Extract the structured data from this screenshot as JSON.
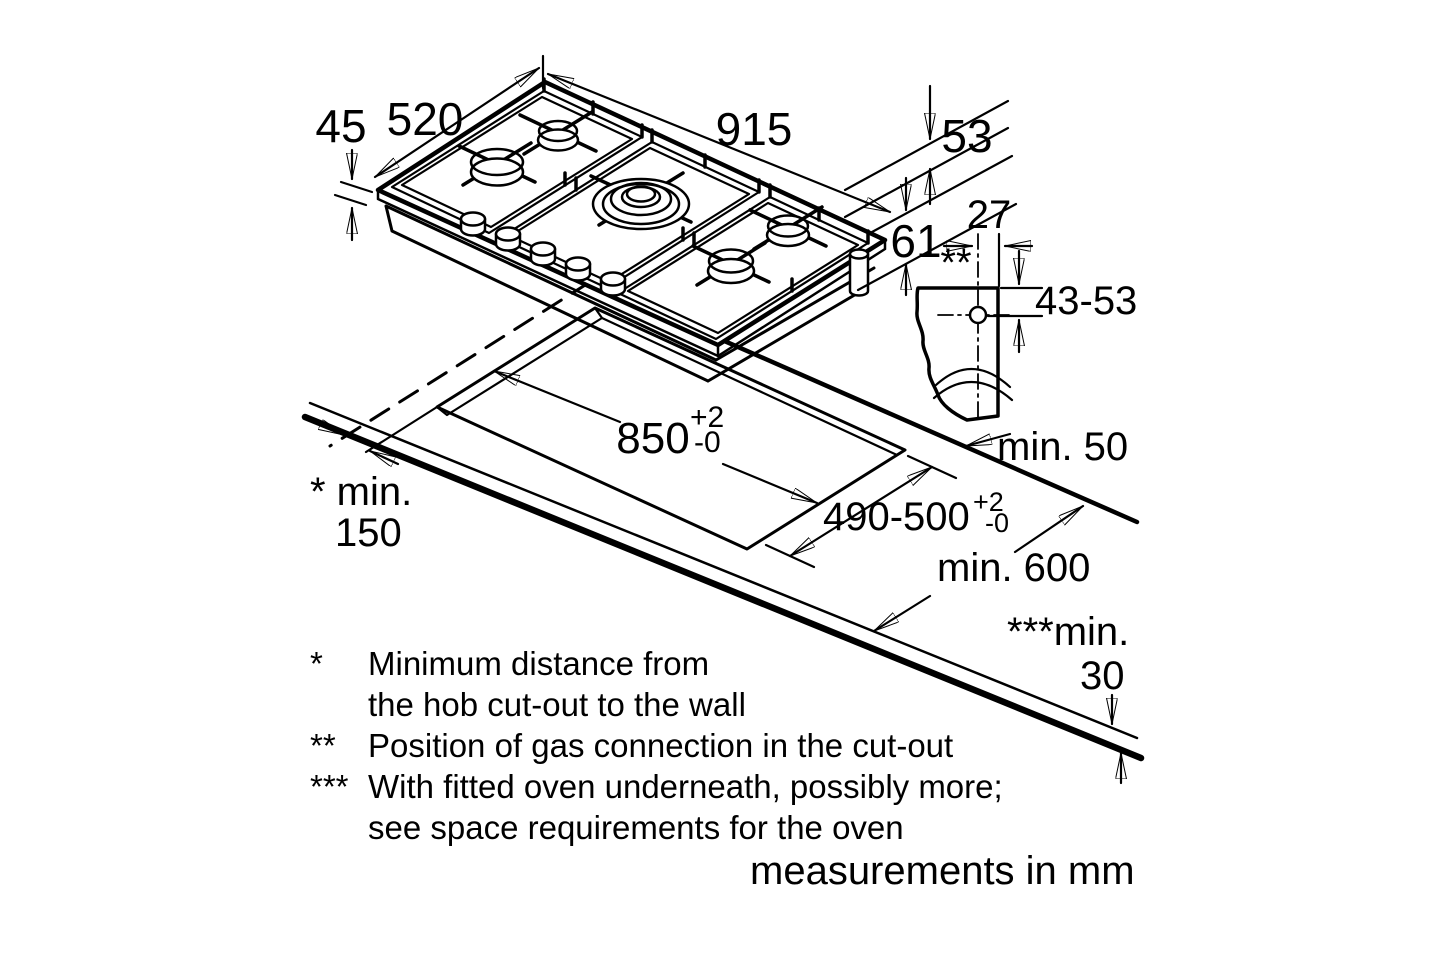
{
  "colors": {
    "line": "#000000",
    "burner": "#c6c6c6",
    "background": "#ffffff"
  },
  "diagram": {
    "hob": {
      "width": "915",
      "depth": "520",
      "height": "45",
      "dim_53": "53",
      "dim_61": "61"
    },
    "gas": {
      "offset": "27",
      "ref_marker": "**",
      "vertical_range": "43-53"
    },
    "cutout": {
      "width": "850",
      "width_tol_plus": "+2",
      "width_tol_minus": "-0",
      "depth": "490-500",
      "depth_tol_plus": "+2",
      "depth_tol_minus": "-0"
    },
    "clearances": {
      "side_line1": "* min.",
      "side_line2": "150",
      "rear": "min. 50",
      "worktop_depth": "min. 600",
      "front_line1": "***min.",
      "front_line2": "30"
    },
    "footnotes": [
      {
        "marker": "*",
        "text": "Minimum distance from"
      },
      {
        "marker": "",
        "text": "the hob cut-out to the wall"
      },
      {
        "marker": "**",
        "text": "Position of gas connection in the cut-out"
      },
      {
        "marker": "***",
        "text": "With fitted oven underneath, possibly more;"
      },
      {
        "marker": "",
        "text": "see space requirements for the oven"
      }
    ],
    "unit_note": "measurements in mm"
  }
}
